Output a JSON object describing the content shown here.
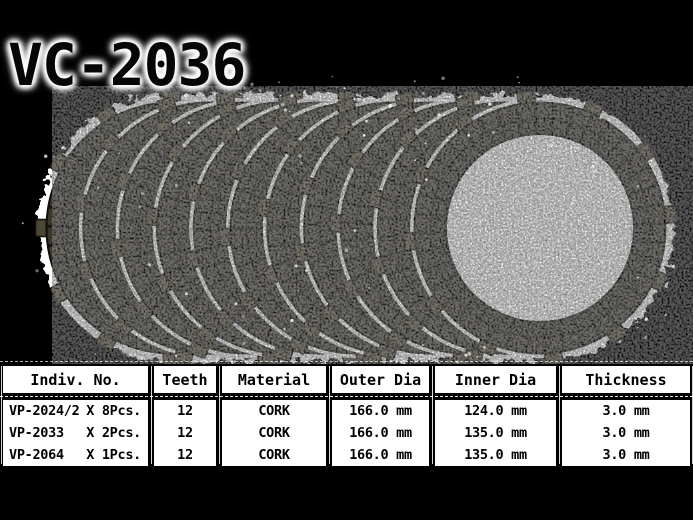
{
  "title": "VC-2036",
  "product": {
    "description": "stack of fanned clutch friction plates on white paper",
    "plate_count": 11,
    "teeth_per_plate": 12
  },
  "table": {
    "columns": [
      "Indiv. No.",
      "Teeth",
      "Material",
      "Outer Dia",
      "Inner Dia",
      "Thickness"
    ],
    "rows": [
      {
        "part": "VP-2024/2",
        "qty": "X 8Pcs.",
        "teeth": "12",
        "material": "CORK",
        "outer_dia": "166.0 mm",
        "inner_dia": "124.0 mm",
        "thickness": "3.0 mm"
      },
      {
        "part": "VP-2033",
        "qty": "X 2Pcs.",
        "teeth": "12",
        "material": "CORK",
        "outer_dia": "166.0 mm",
        "inner_dia": "135.0 mm",
        "thickness": "3.0 mm"
      },
      {
        "part": "VP-2064",
        "qty": "X 1Pcs.",
        "teeth": "12",
        "material": "CORK",
        "outer_dia": "166.0 mm",
        "inner_dia": "135.0 mm",
        "thickness": "3.0 mm"
      }
    ]
  },
  "colors": {
    "background": "#000000",
    "paper_white": "#ffffff",
    "plate_ring": "#34312a",
    "plate_outer_row": "#3e3a2f",
    "plate_groove": "#12110c",
    "plate_edge": "#100f0a",
    "plate_tab": "#4b4635",
    "cell_background": "#ffffff",
    "text": "#000000"
  }
}
